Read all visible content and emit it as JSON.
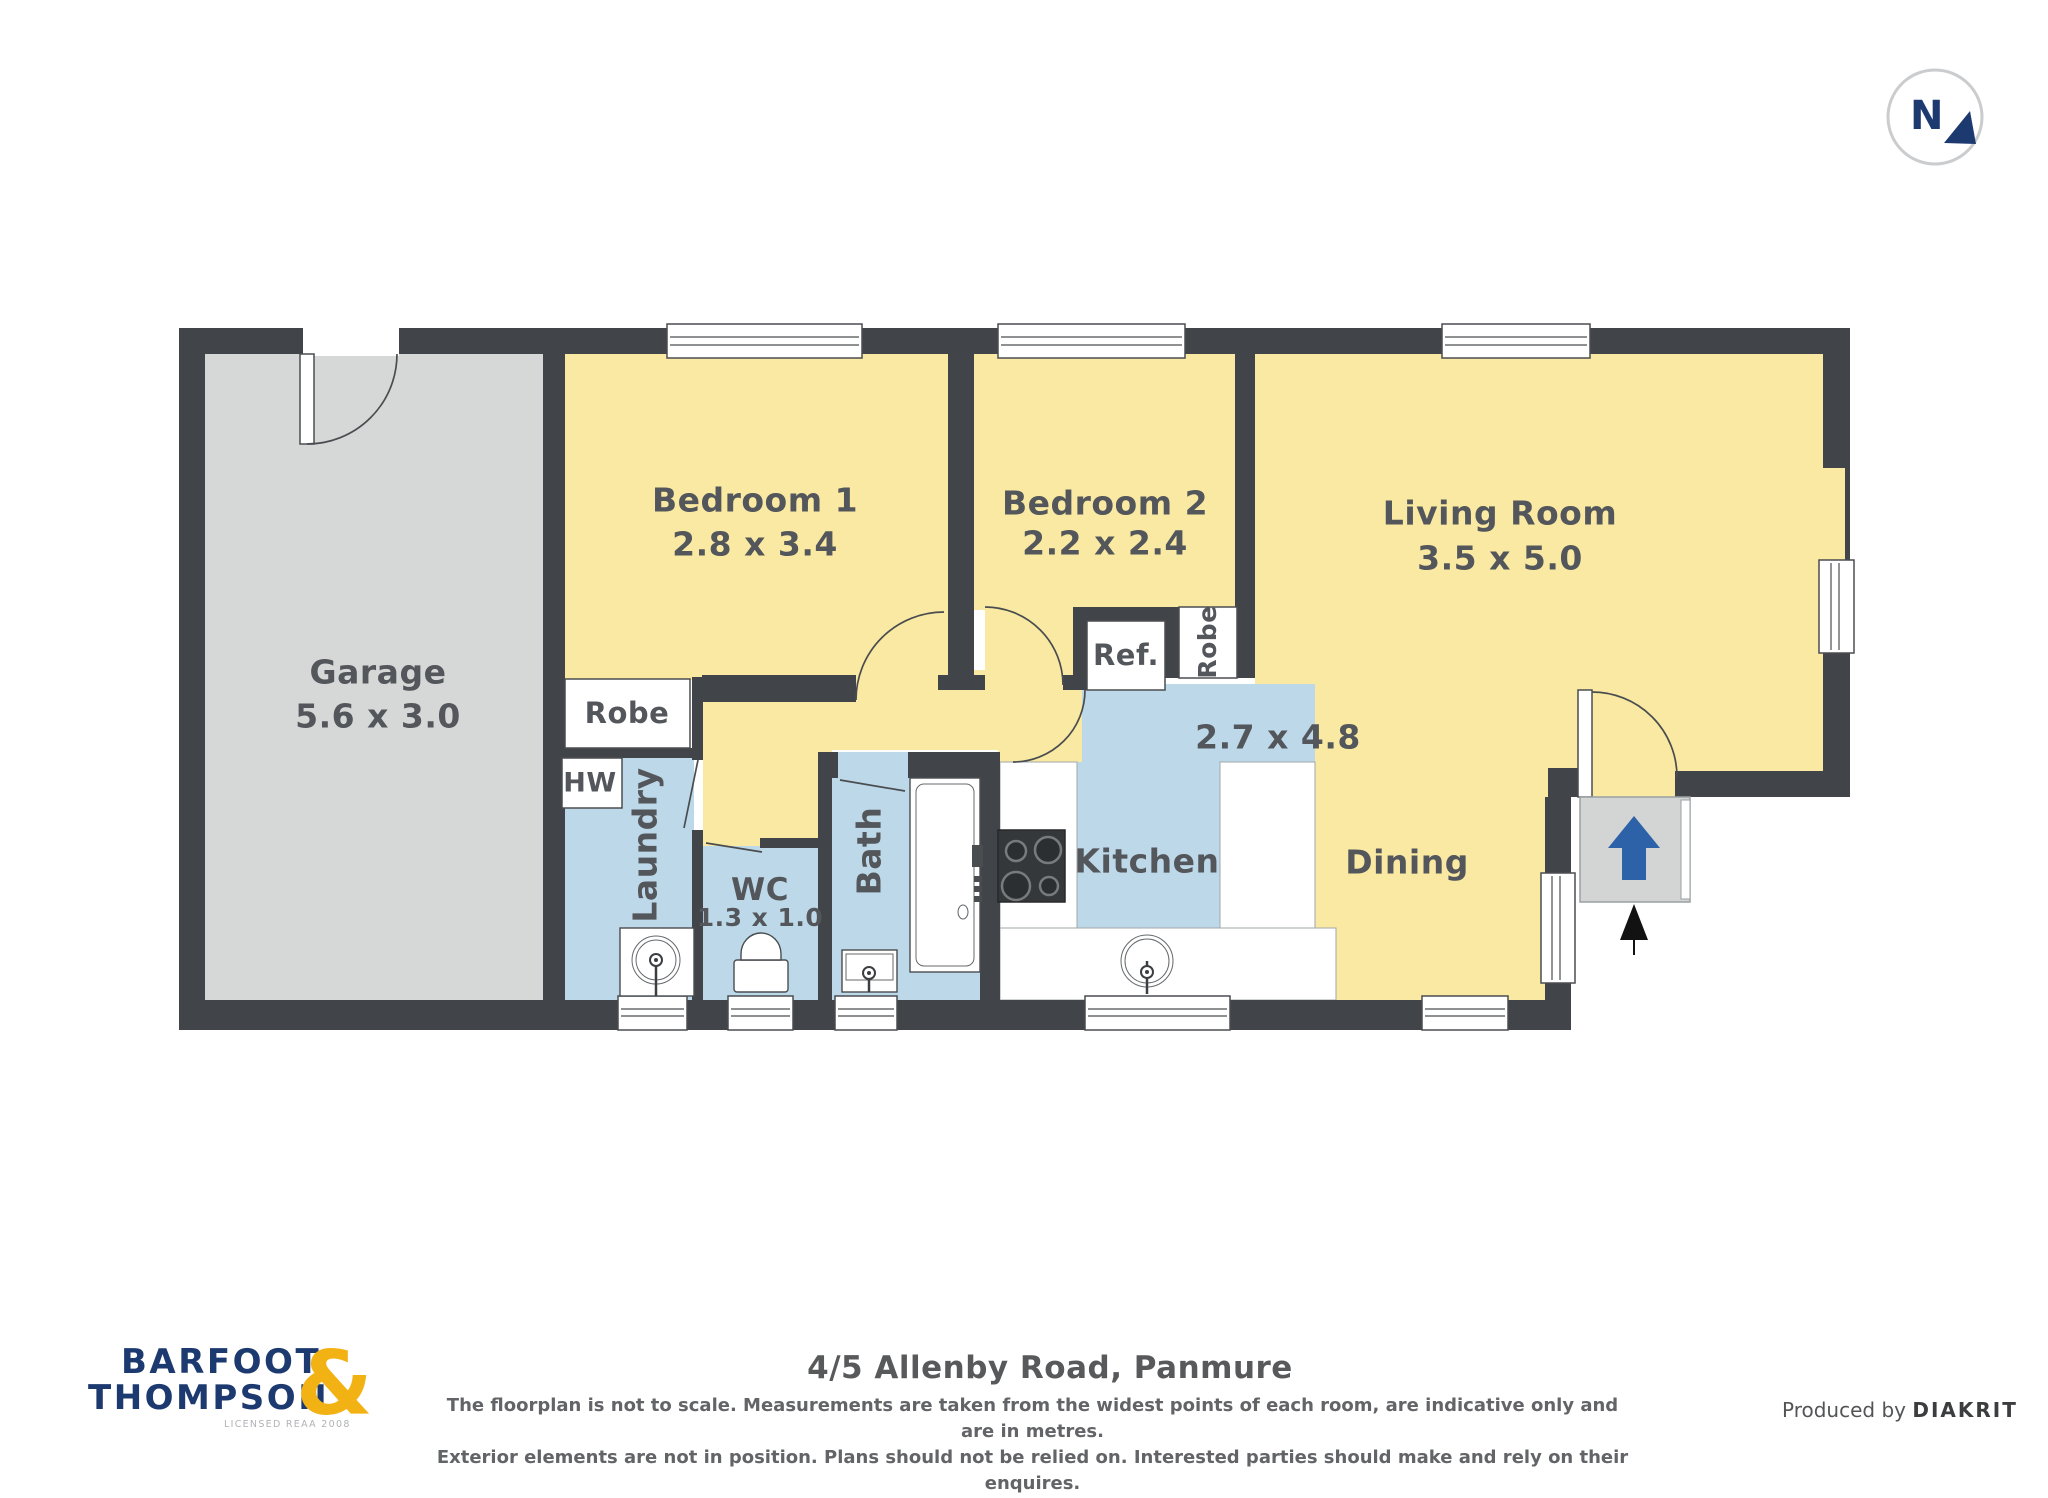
{
  "compass": {
    "north_label": "N"
  },
  "plan": {
    "garage": {
      "name": "Garage",
      "dims": "5.6 x 3.0"
    },
    "bedroom1": {
      "name": "Bedroom 1",
      "dims": "2.8 x 3.4"
    },
    "bedroom2": {
      "name": "Bedroom 2",
      "dims": "2.2 x 2.4"
    },
    "living": {
      "name": "Living Room",
      "dims": "3.5 x 5.0"
    },
    "kitchen": {
      "name": "Kitchen"
    },
    "kitchen_dining": {
      "dims": "2.7 x 4.8"
    },
    "dining": {
      "name": "Dining"
    },
    "laundry": {
      "name": "Laundry"
    },
    "wc": {
      "name": "WC",
      "dims": "1.3 x 1.0"
    },
    "bath": {
      "name": "Bath"
    },
    "robe_bed1": {
      "label": "Robe"
    },
    "robe_bed2": {
      "label": "Robe"
    },
    "hw": {
      "label": "HW"
    },
    "ref": {
      "label": "Ref."
    }
  },
  "footer": {
    "brand_line1": "BARFOOT",
    "brand_line2": "THOMPSON",
    "brand_amp": "&",
    "brand_licensed": "LICENSED REAA 2008",
    "address": "4/5 Allenby Road, Panmure",
    "disclaimer_line1": "The floorplan is not to scale. Measurements are taken from the widest points of each room, are indicative only and are in metres.",
    "disclaimer_line2": "Exterior elements are not in position. Plans should not be relied on. Interested parties should make and rely on their enquires.",
    "produced_prefix": "Produced by",
    "produced_brand": "DIAKRIT"
  },
  "colors": {
    "wall": "#414448",
    "room_yellow": "#f9e9a3",
    "room_blue": "#bdd8e9",
    "garage_gray": "#d6d8d7",
    "porch_gray": "#d3d5d4",
    "line": "#4a4d50",
    "label": "#53565a",
    "brand_navy": "#1d3a70",
    "brand_gold": "#f2b214",
    "arrow_blue": "#2e62a8",
    "text_gray": "#58595b"
  }
}
